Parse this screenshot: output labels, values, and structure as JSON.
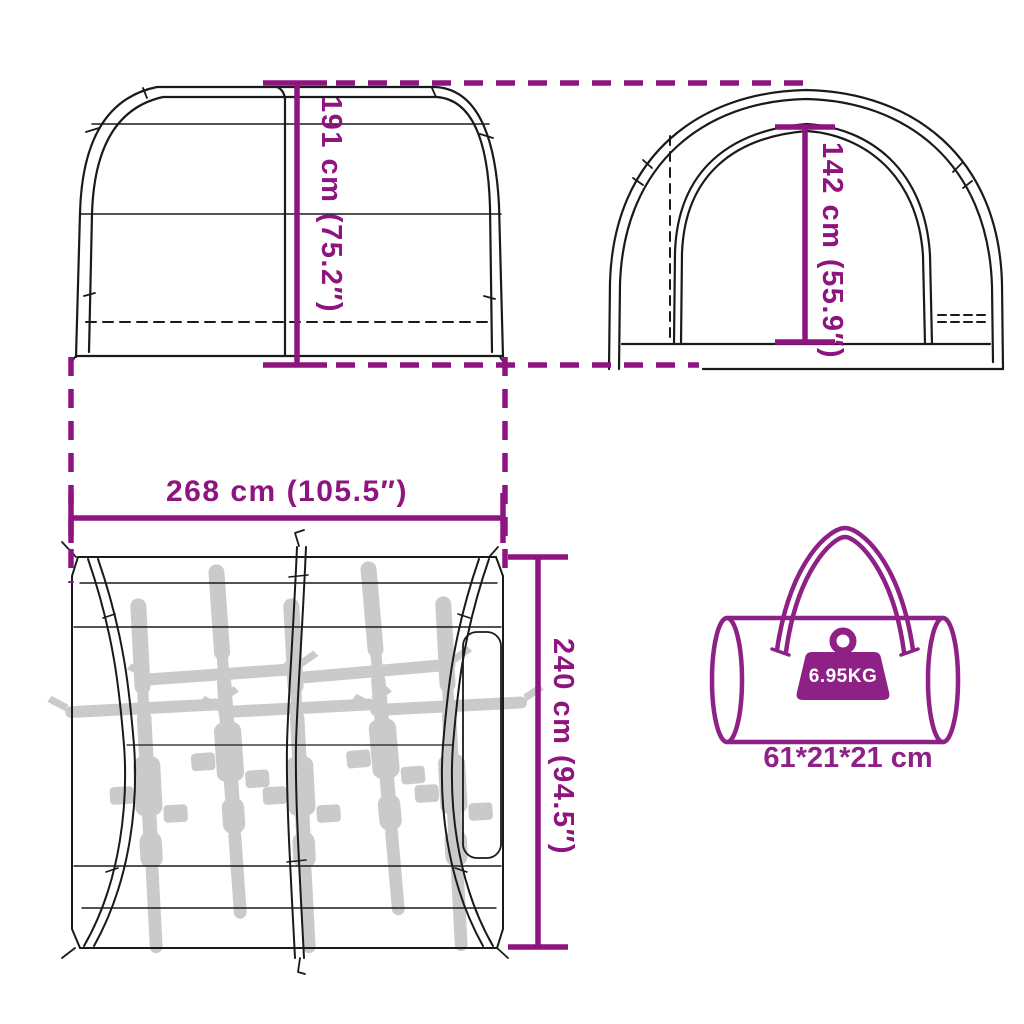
{
  "colors": {
    "accent": "#8E1580",
    "bag": "#8E2186",
    "line": "#1a1a1a",
    "bike": "#c6c6c6",
    "badge_text": "#ffffff",
    "background": "#ffffff"
  },
  "dimensions": {
    "side_height": {
      "label": "191 cm (75.2″)"
    },
    "front_height": {
      "label": "142 cm (55.9″)"
    },
    "top_width": {
      "label": "268 cm (105.5″)"
    },
    "top_depth": {
      "label": "240 cm (94.5″)"
    }
  },
  "carry_bag": {
    "weight": "6.95KG",
    "size": "61*21*21 cm"
  },
  "top_view": {
    "bike_count": 5
  }
}
